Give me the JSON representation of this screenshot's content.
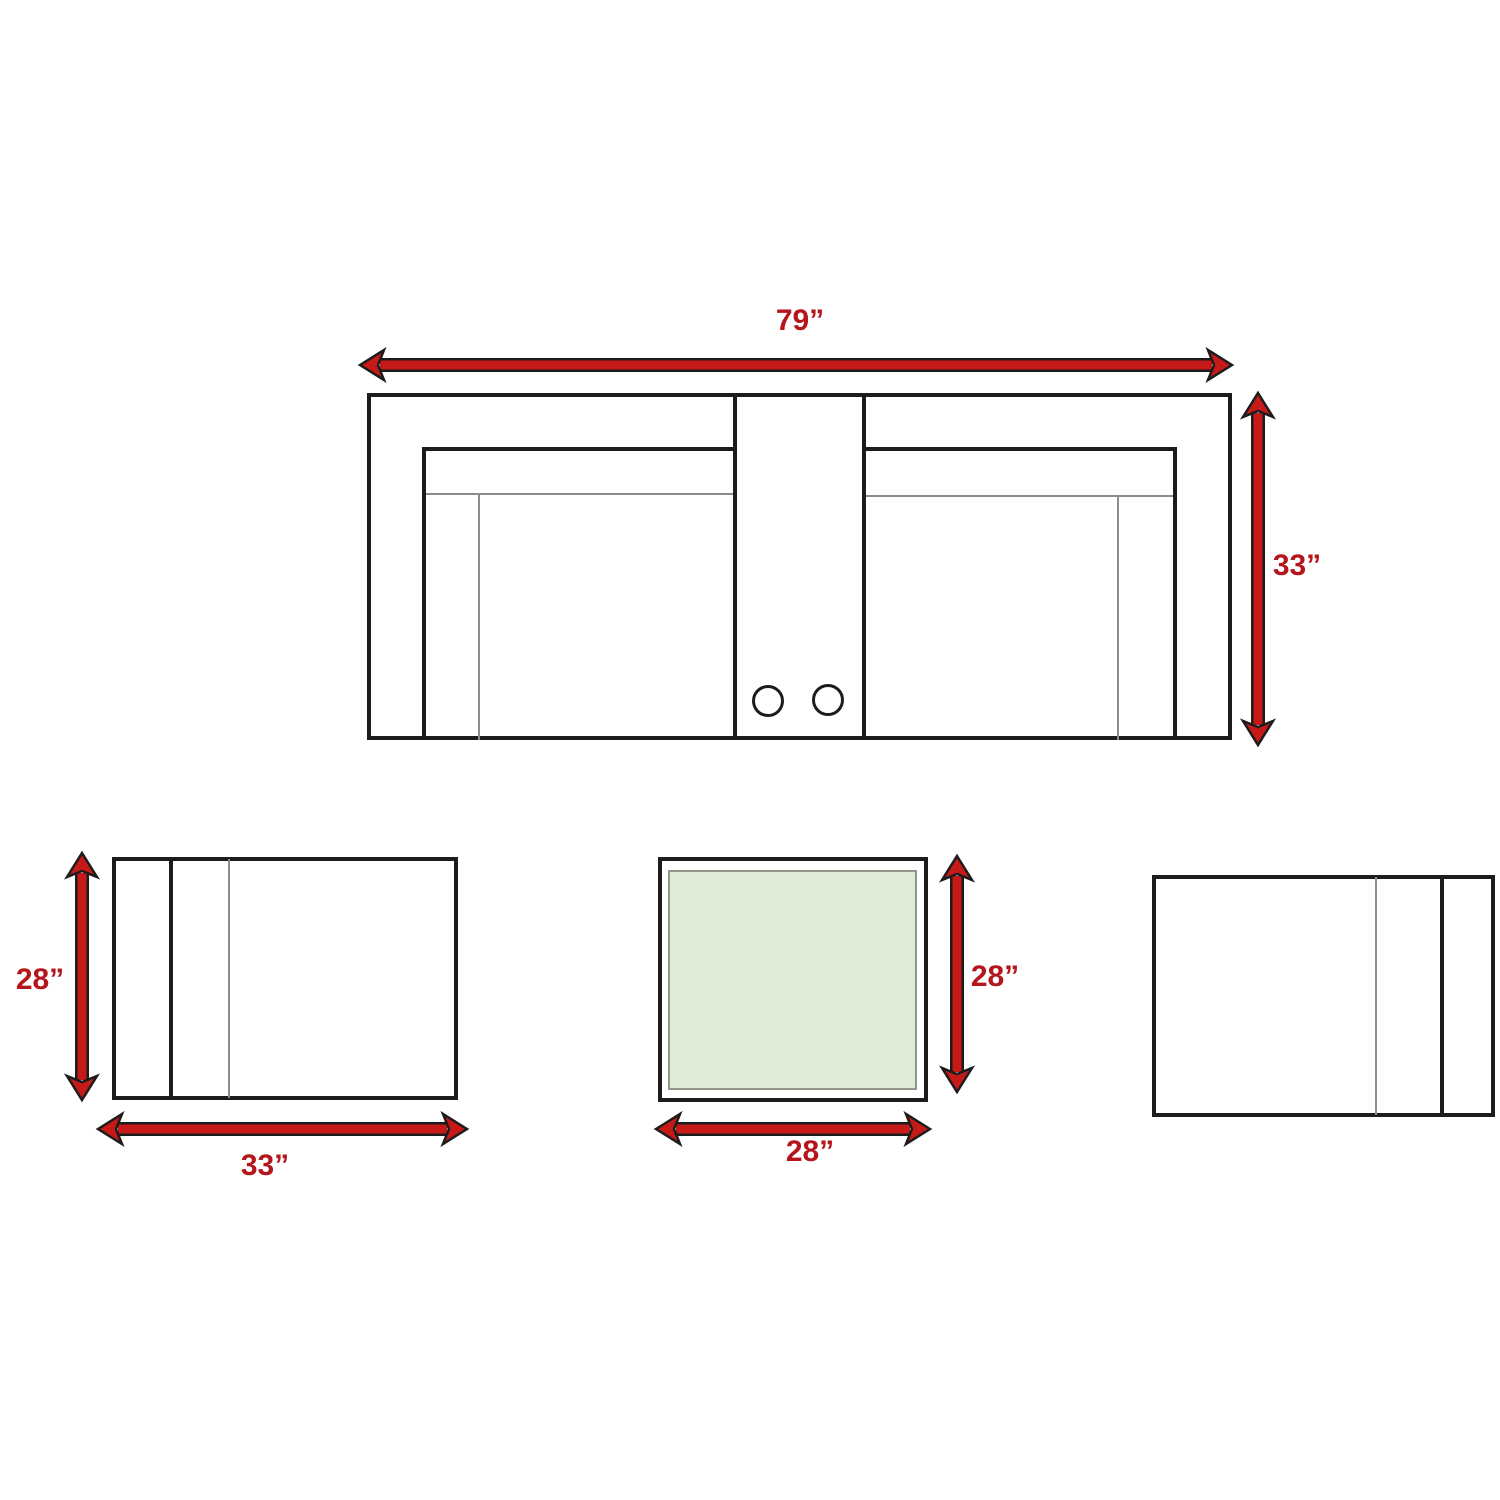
{
  "colors": {
    "background": "#ffffff",
    "line_black": "#1c1c1c",
    "line_gray": "#8c8c8c",
    "arrow_red": "#c51a18",
    "label_red": "#b5161c",
    "glass_green": "#e0ebd5",
    "glass_border": "#8f978b"
  },
  "sofa": {
    "width_label": "79”",
    "depth_label": "33”",
    "cupholder_count": 2
  },
  "left_chair": {
    "depth_label": "28”",
    "width_label": "33”"
  },
  "table": {
    "depth_label": "28”",
    "width_label": "28”"
  }
}
